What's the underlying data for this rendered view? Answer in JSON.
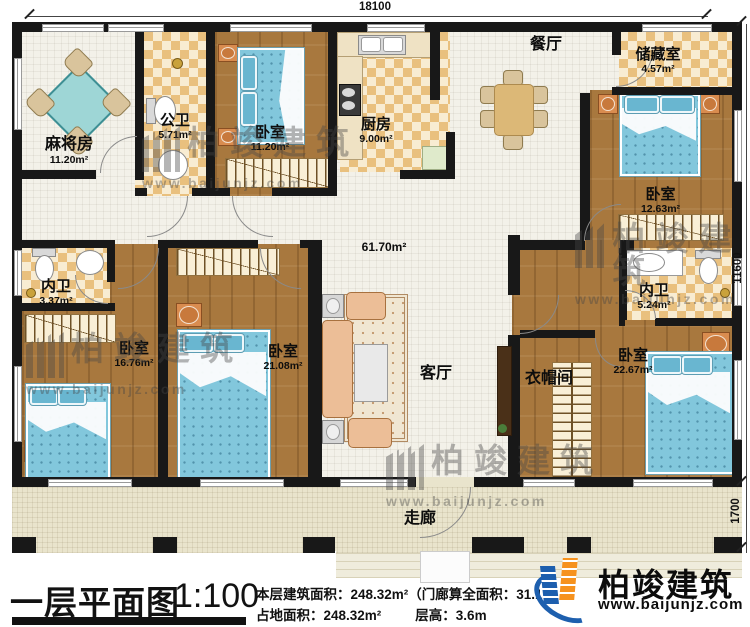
{
  "plan": {
    "title": "一层平面图",
    "scale": "1:100",
    "hall_area": "61.70m²"
  },
  "dims": {
    "top": "18100",
    "right": "11600",
    "porch": "1700"
  },
  "rooms": {
    "majiang": {
      "name": "麻将房",
      "area": "11.20m²"
    },
    "gongwei": {
      "name": "公卫",
      "area": "5.71m²"
    },
    "woshi1": {
      "name": "卧室",
      "area": "11.20m²"
    },
    "chufang": {
      "name": "厨房",
      "area": "9.00m²"
    },
    "canting": {
      "name": "餐厅"
    },
    "chucangshi": {
      "name": "储藏室",
      "area": "4.57m²"
    },
    "woshi2": {
      "name": "卧室",
      "area": "12.63m²"
    },
    "neiwei1": {
      "name": "内卫",
      "area": "3.37m²"
    },
    "woshi3": {
      "name": "卧室",
      "area": "16.76m²"
    },
    "woshi4": {
      "name": "卧室",
      "area": "21.08m²"
    },
    "keting": {
      "name": "客厅"
    },
    "neiwei2": {
      "name": "内卫",
      "area": "5.24m²"
    },
    "yimaojian": {
      "name": "衣帽间"
    },
    "woshi5": {
      "name": "卧室",
      "area": "22.67m²"
    },
    "zoulang": {
      "name": "走廊"
    }
  },
  "titleblock": {
    "line1": "本层建筑面积：248.32m²（门廊算全面积：31.1",
    "line2a": "占地面积：248.32m²",
    "line2b": "层高：3.6m"
  },
  "brand": {
    "name": "柏竣建筑",
    "url": "www.baijunjz.com"
  },
  "colors": {
    "wall": "#181818",
    "wood_floor": "#a8783e",
    "tile_floor": "#e9c07e",
    "bed_blue": "#82c7dc",
    "brand_blue": "#1d5fae",
    "brand_orange": "#f6921e"
  }
}
